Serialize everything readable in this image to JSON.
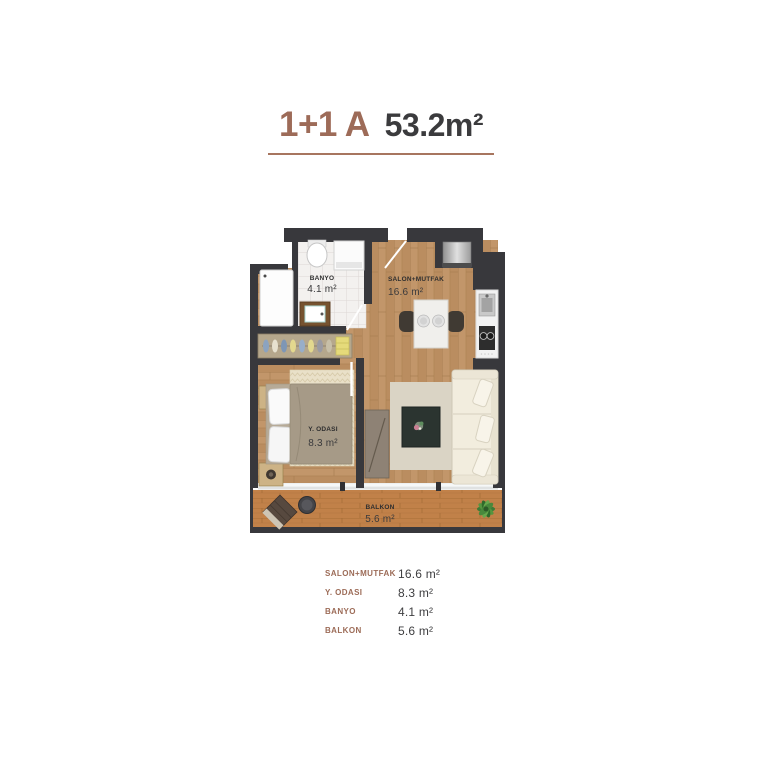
{
  "header": {
    "unit_type": "1+1 A",
    "total_area": "53.2m²"
  },
  "plan": {
    "rooms": {
      "banyo": {
        "label": "BANYO",
        "area": "4.1 m²"
      },
      "salon_mutfak": {
        "label": "SALON+MUTFAK",
        "area": "16.6 m²"
      },
      "y_odasi": {
        "label": "Y. ODASI",
        "area": "8.3 m²"
      },
      "balkon": {
        "label": "BALKON",
        "area": "5.6 m²"
      }
    }
  },
  "legend": {
    "rows": [
      {
        "label": "SALON+MUTFAK",
        "value": "16.6 m²"
      },
      {
        "label": "Y. ODASI",
        "value": "8.3 m²"
      },
      {
        "label": "BANYO",
        "value": "4.1 m²"
      },
      {
        "label": "BALKON",
        "value": "5.6 m²"
      }
    ]
  },
  "colors": {
    "accent_brown": "#9c6b57",
    "text_dark": "#3a3a3c",
    "wall": "#38383c",
    "wood": "#c2966a",
    "deck": "#c18149"
  }
}
